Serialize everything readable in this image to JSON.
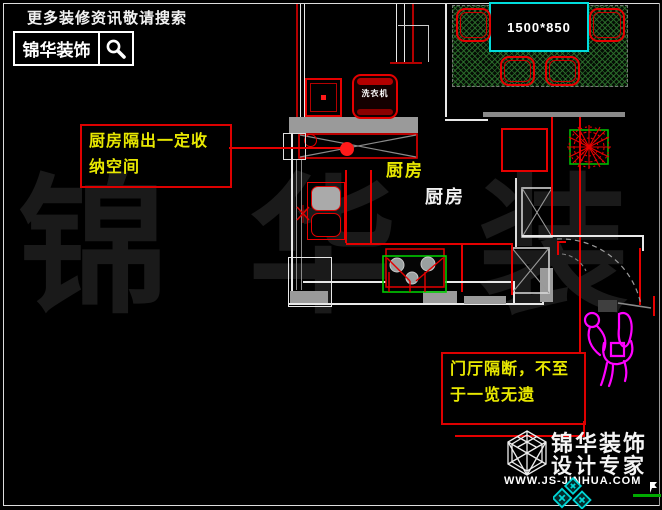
{
  "header": {
    "tagline": "更多装修资讯敬请搜索",
    "brand": "锦华装饰",
    "search_icon": "magnifier-icon"
  },
  "annotations": {
    "kitchen_note": {
      "line1": "厨房隔出一定收",
      "line2": "纳空间"
    },
    "hall_note": {
      "line1": "门厅隔断，不至",
      "line2": "于一览无遗"
    }
  },
  "plan": {
    "dining_table_size": "1500*850",
    "kitchen_label_yellow": "厨房",
    "kitchen_label_white": "厨房",
    "washing_machine_label": "洗衣机"
  },
  "watermark": "锦 华 装 饰",
  "footer_logo": {
    "brand_line1": "锦华装饰",
    "brand_line2": "设计专家",
    "website": "WWW.JS-JINHUA.COM",
    "logo_icon": "cube-logo-icon"
  },
  "colors": {
    "cad_red": "#e60000",
    "cad_yellow": "#e8e800",
    "cad_cyan": "#00dcdc",
    "cad_green": "#00cc00",
    "wall_gray": "#999999",
    "figure_magenta": "#ff00ff",
    "watermark_gray": "#1a1a1a"
  }
}
